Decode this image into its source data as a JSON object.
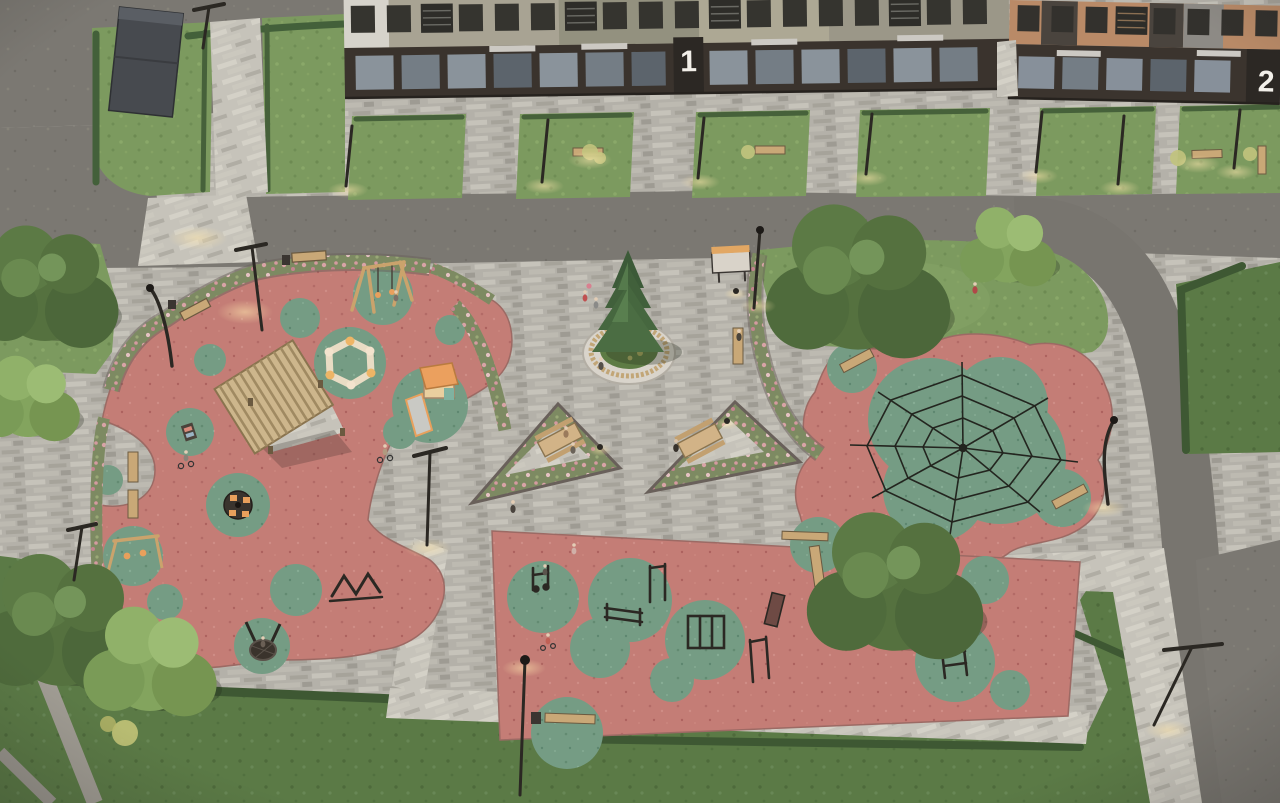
{
  "scene": {
    "type": "3D architectural aerial render",
    "description": "Dusk aerial view of a residential courtyard with toddler playground, rope-pyramid climbing area, outdoor fitness zone and a paved plaza with a central spruce tree",
    "time_of_day": "dusk, site lighting on"
  },
  "buildings": {
    "building_1": {
      "entrance_number": "1",
      "facade": "beige / olive upper floors, dark brown ground floor with storefronts"
    },
    "building_2": {
      "entrance_number": "2",
      "facade": "terracotta and dark brown panels"
    }
  },
  "zones": {
    "toddler_playground": {
      "surface": "red rubber with green organic insets",
      "equipment": [
        "pergola with slatted canopy",
        "hexagonal sandbox",
        "slide tower with orange roof",
        "swing set",
        "toddler swings",
        "carousel",
        "nest swing",
        "activity panel",
        "climbing frame"
      ]
    },
    "climbing_area": {
      "surface": "red rubber with large green inset",
      "equipment": [
        "rope pyramid climbing net"
      ]
    },
    "fitness_area": {
      "surface": "red rubber with green circles",
      "equipment": [
        "exercise machine",
        "parallel bars",
        "pull-up bars",
        "monkey-bar frame",
        "incline bench",
        "ladder frame"
      ]
    },
    "central_plaza": {
      "features": [
        "spruce tree in round planter",
        "white circular perimeter bench",
        "two triangular flower beds with picnic tables",
        "information board"
      ]
    }
  },
  "site_furniture": [
    "wooden benches",
    "litter bins",
    "bollard lights",
    "T-shaped lampposts",
    "information board"
  ],
  "landscape": [
    "grey paver plaza",
    "asphalt loop road",
    "lawns",
    "clipped hedges",
    "pink flowering borders",
    "deciduous trees",
    "ornamental grasses",
    "utility shed"
  ],
  "people": [
    "children with bicycles",
    "child on tricycle",
    "pedestrians",
    "people at picnic tables",
    "person on bench"
  ],
  "colors": {
    "rubber_red": "#c47d76",
    "rubber_green": "#759c84",
    "pavers": "#b4b1a9",
    "asphalt": "#78756f",
    "lawn": "#7c9a5f",
    "lawn_dark": "#5b7a46",
    "flowers_pink": "#d8a3a6",
    "wood": "#c9a877",
    "equipment_dark": "#2b2823",
    "accent_orange": "#e8a05c"
  }
}
